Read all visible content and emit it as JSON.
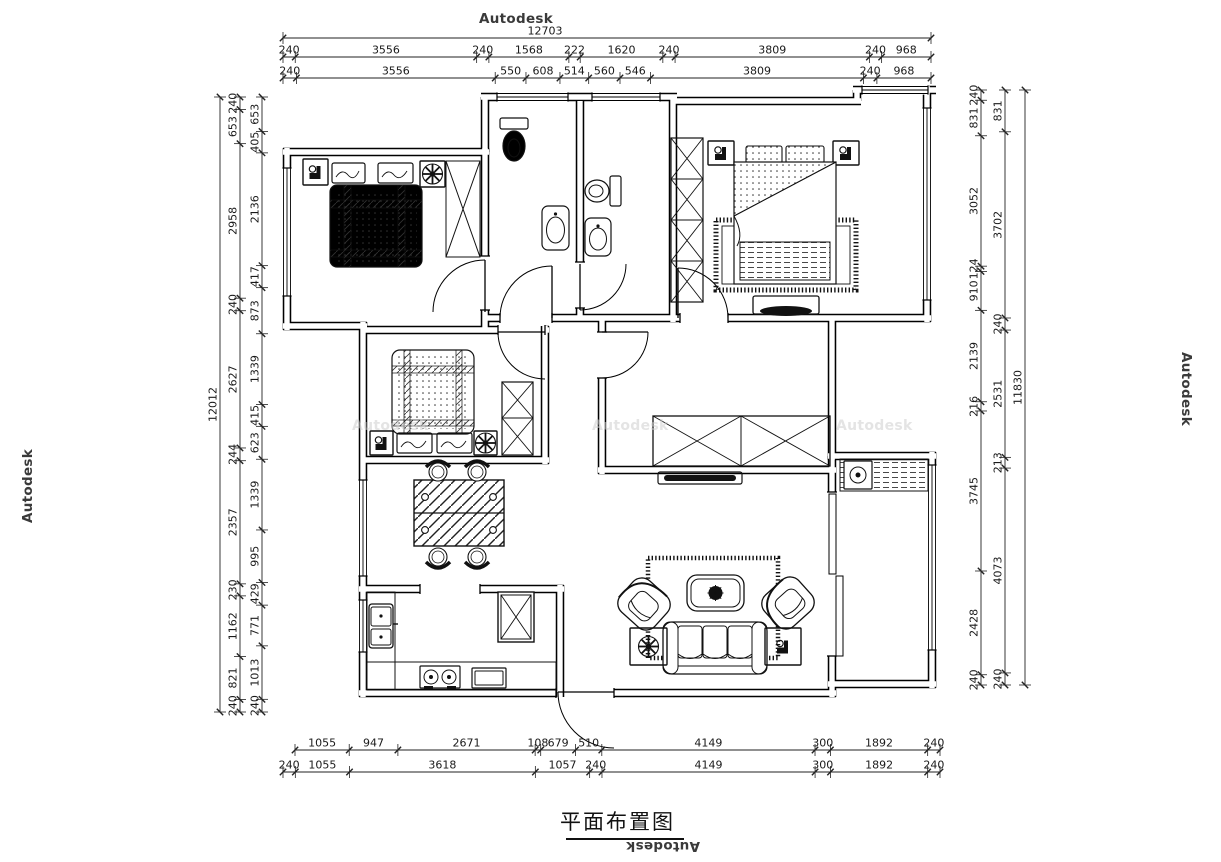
{
  "title": "平面布置图",
  "watermark": "Autodesk",
  "dimensions": {
    "top": {
      "overall": "12703",
      "row1": [
        "240",
        "3556",
        "240",
        "1568",
        "222",
        "1620",
        "240",
        "3809",
        "240",
        "968"
      ],
      "row2": [
        "240",
        "3556",
        "550",
        "608",
        "514",
        "560",
        "546",
        "3809",
        "240",
        "968"
      ]
    },
    "bottom": {
      "row1": [
        "1055",
        "947",
        "2671",
        "108",
        "679",
        "510",
        "4149",
        "300",
        "1892",
        "240"
      ],
      "row2": [
        "240",
        "1055",
        "3618",
        "1057",
        "240",
        "4149",
        "300",
        "1892",
        "240"
      ]
    },
    "left": {
      "overall": "12012",
      "outer": [
        "240",
        "653",
        "2958",
        "240",
        "2627",
        "244",
        "2357",
        "230",
        "1162",
        "821",
        "240"
      ],
      "inner": [
        "653",
        "405",
        "2136",
        "417",
        "873",
        "1339",
        "415",
        "623",
        "1339",
        "995",
        "429",
        "771",
        "1013",
        "240"
      ]
    },
    "right": {
      "overall": "11830",
      "inner": [
        "240",
        "831",
        "3052",
        "124",
        "910",
        "2139",
        "216",
        "3745",
        "2428",
        "240"
      ],
      "outer": [
        "831",
        "3702",
        "240",
        "2531",
        "213",
        "4073",
        "240"
      ]
    }
  }
}
